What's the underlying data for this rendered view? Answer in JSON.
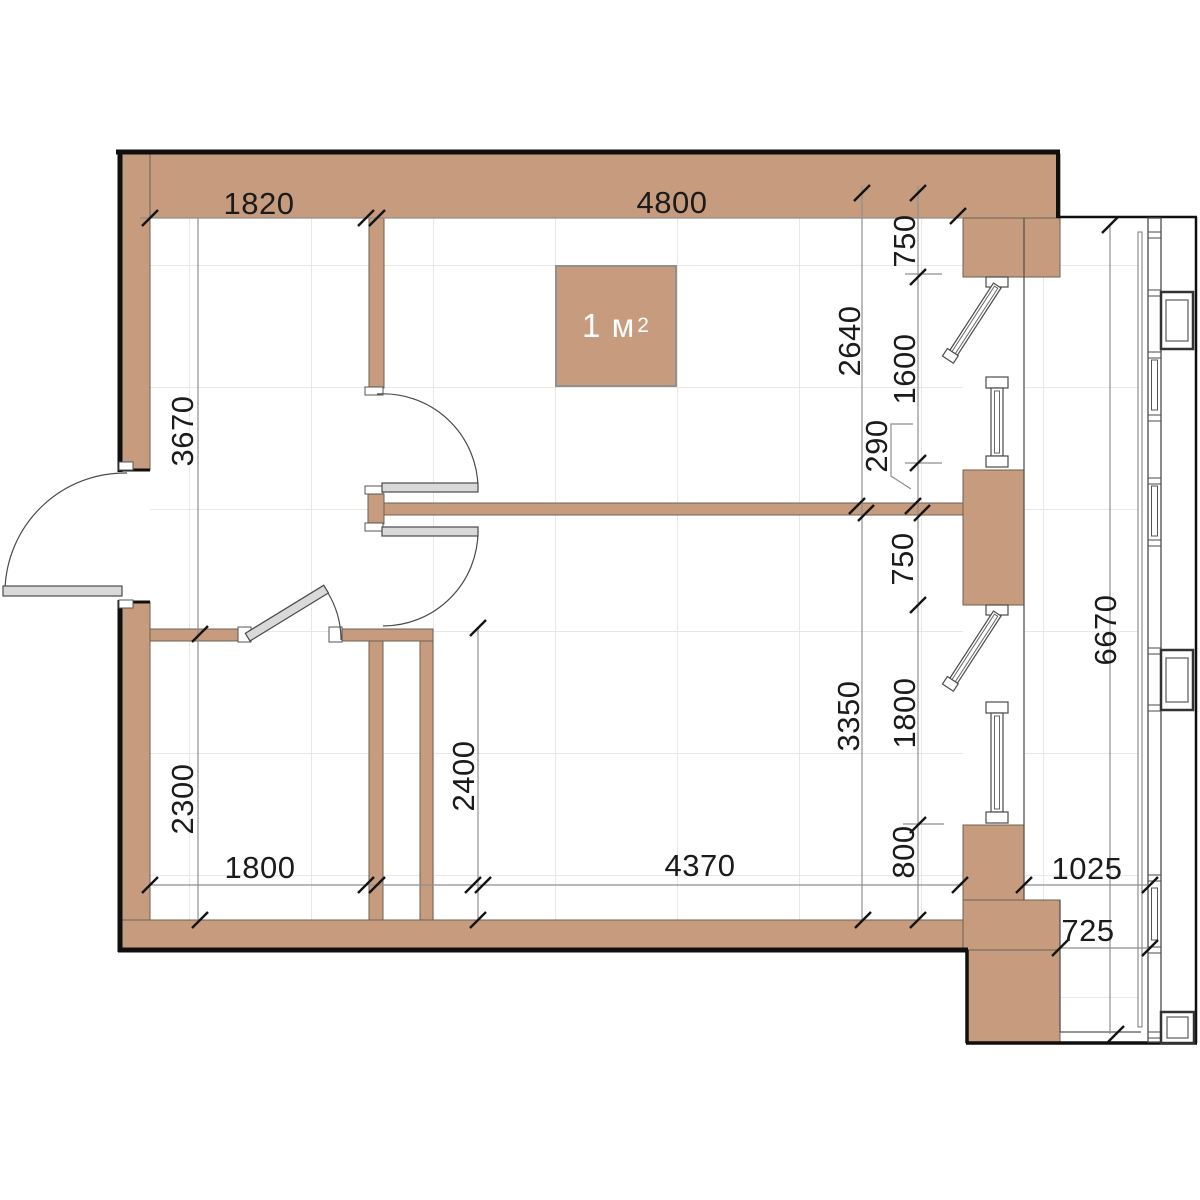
{
  "plan": {
    "area": {
      "text": "1 м",
      "sup": "2"
    },
    "dims": {
      "top_left": "1820",
      "top_right": "4800",
      "left_upper": "3670",
      "left_lower": "2300",
      "bath_width": "1800",
      "shaft_depth": "2400",
      "bottom_main": "4370",
      "right_room_upper": "2640",
      "right_room_lower": "3350",
      "win1_offset": "750",
      "win1_height": "1600",
      "win_gap": "290",
      "pier_mid": "750",
      "win2_height": "1800",
      "win2_offset": "800",
      "balcony_length": "6670",
      "balcony_top_width": "1025",
      "balcony_bottom_width": "725"
    },
    "colors": {
      "wall_fill": "#c69b7e",
      "wall_edge": "#6e6053",
      "exterior_outline": "#0f0f0f",
      "dimension_line": "#8f8f8f",
      "tick": "#141414",
      "door_leaf": "#d9d9d9",
      "frame_stroke": "#4a4a4a",
      "text": "#1b1b1b",
      "grid": "#ebe8e4",
      "area_badge_border": "#909090"
    }
  }
}
